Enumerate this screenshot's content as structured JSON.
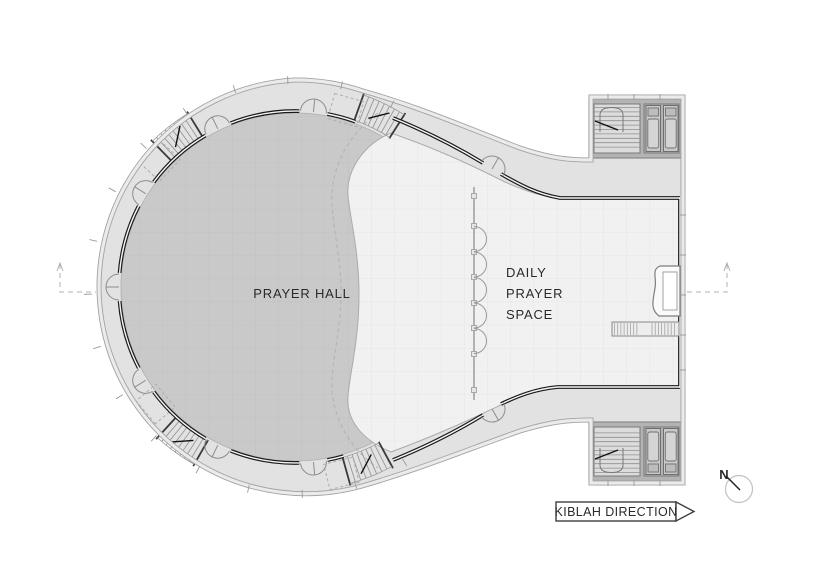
{
  "plan": {
    "labels": {
      "prayer_hall": "PRAYER HALL",
      "daily_prayer_space": [
        "DAILY",
        "PRAYER",
        "SPACE"
      ]
    },
    "rooms": [
      "Prayer hall",
      "Daily prayer space",
      "Stair core",
      "Elevator core"
    ],
    "icons": [
      "kiblah-arrow-icon",
      "north-compass-icon",
      "door-swing-icon",
      "stair-icon",
      "elevator-icon",
      "mihrab-niche-icon"
    ]
  },
  "kiblah": {
    "label": "KIBLAH DIRECTION"
  },
  "compass": {
    "north_label": "N"
  },
  "colors": {
    "band": "#e2e2e2",
    "hall": "#c9c9c9",
    "floor_light": "#f1f1f1",
    "wall_dark": "#1a1a1a",
    "block_wall": "#b3b3b3",
    "annotation": "#2a2a2a"
  }
}
